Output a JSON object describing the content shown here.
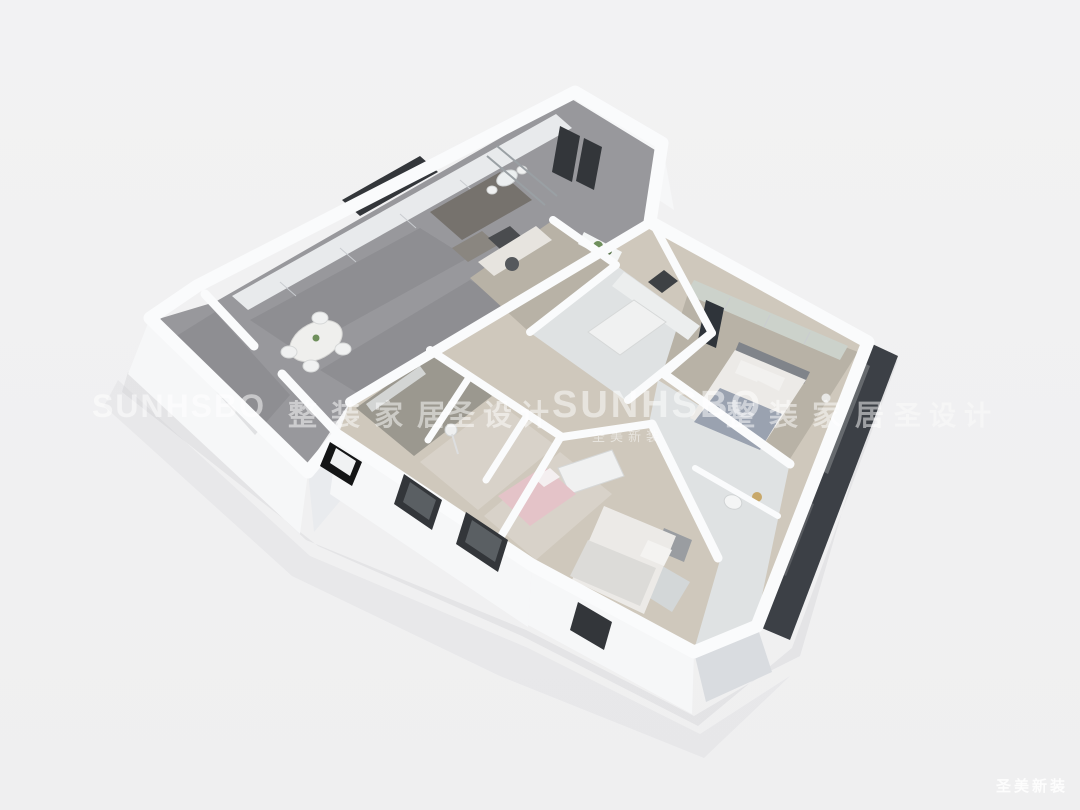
{
  "scene": {
    "alt": "3D rendered floor plan of an apartment"
  },
  "watermarks": {
    "row": [
      "SUNHSBO",
      "整装家居",
      "圣设计",
      "SUNHSBO",
      "整装家居",
      "圣设计"
    ],
    "center_sub": "圣美新装",
    "corner": "圣美新装"
  },
  "palette": {
    "background": "#f2f2f3",
    "wall_white": "#fafbfc",
    "wall_face": "#e9ebee",
    "wall_face_shade": "#d9dce0",
    "wall_dark": "#3c4046",
    "floor_marble": "#98989c",
    "floor_wood": "#cfc8bc",
    "floor_wood_dark": "#b8b2a6",
    "floor_tile": "#dfe2e3",
    "sofa": "#76726d",
    "accent_dark": "#33363a",
    "bed_blanket": "#9aa2b0",
    "linen_white": "#eceae7",
    "wardrobe_sage": "#ccd2cb",
    "accent_pink": "#e4c3c8",
    "plant_green": "#6f8f5c",
    "watermark": "rgba(255,255,255,0.5)"
  }
}
